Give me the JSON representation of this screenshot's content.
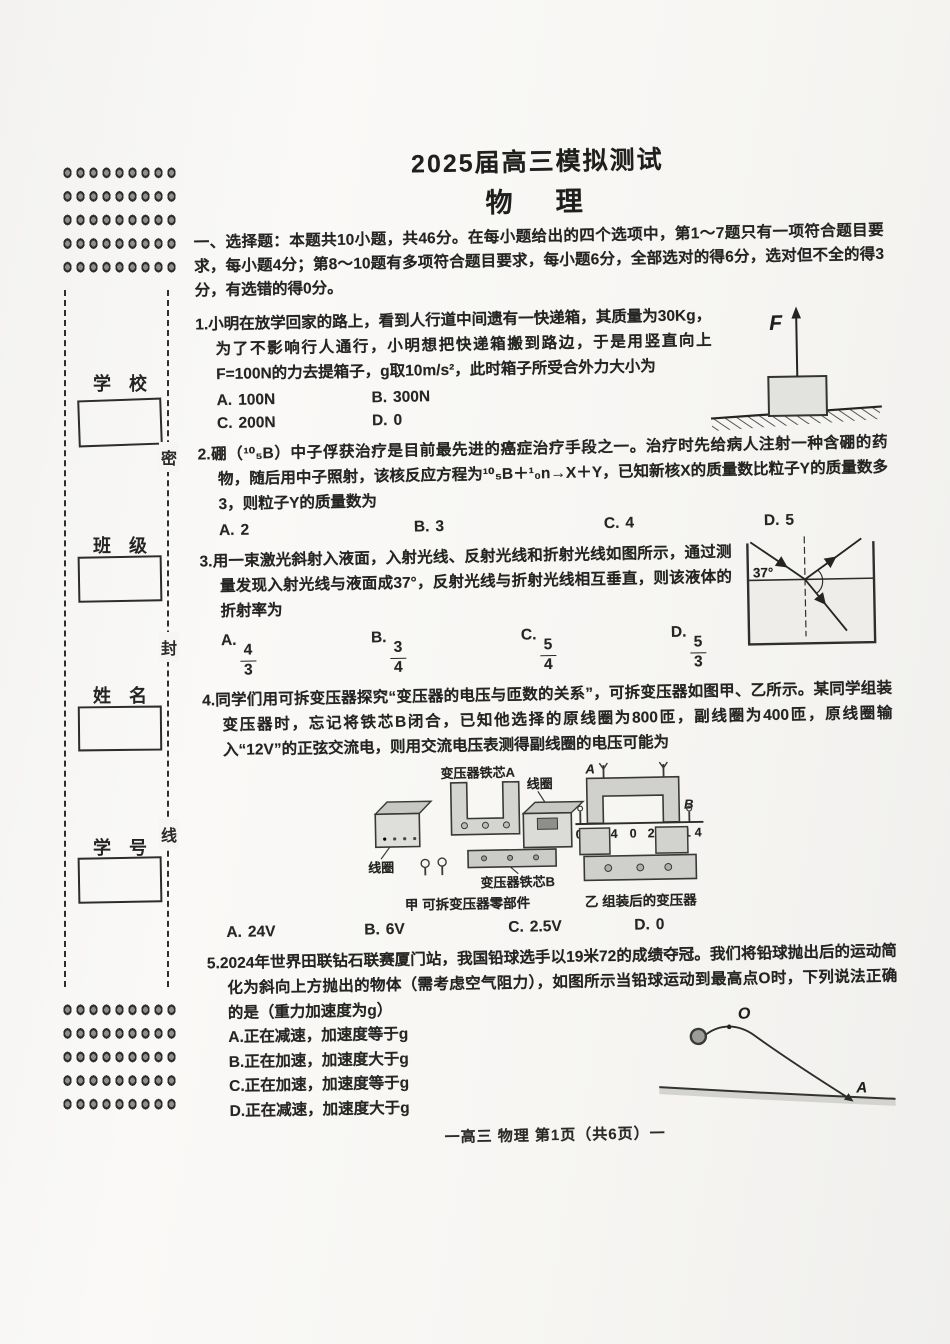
{
  "header": {
    "title": "2025届高三模拟测试",
    "subject": "物　理",
    "footer": "一高三 物理 第1页（共6页）一"
  },
  "sidebar": {
    "seal_chars": [
      "密",
      "封",
      "线"
    ],
    "fields": [
      {
        "label": "学　校"
      },
      {
        "label": "班　级"
      },
      {
        "label": "姓　名"
      },
      {
        "label": "学　号"
      }
    ]
  },
  "section": {
    "intro": "一、选择题：本题共10小题，共46分。在每小题给出的四个选项中，第1～7题只有一项符合题目要求，每小题4分；第8～10题有多项符合题目要求，每小题6分，全部选对的得6分，选对但不全的得3分，有选错的得0分。"
  },
  "questions": [
    {
      "stem": "1.小明在放学回家的路上，看到人行道中间遗有一快递箱，其质量为30Kg，为了不影响行人通行，小明想把快递箱搬到路边，于是用竖直向上F=100N的力去提箱子，g取10m/s²，此时箱子所受合外力大小为",
      "options": [
        {
          "label": "A.",
          "text": "100N"
        },
        {
          "label": "B.",
          "text": "300N"
        },
        {
          "label": "C.",
          "text": "200N"
        },
        {
          "label": "D.",
          "text": "0"
        }
      ],
      "figure": {
        "force_label": "F"
      }
    },
    {
      "stem": "2.硼（¹⁰₅B）中子俘获治疗是目前最先进的癌症治疗手段之一。治疗时先给病人注射一种含硼的药物，随后用中子照射，该核反应方程为¹⁰₅B＋¹₀n→X＋Y，已知新核X的质量数比粒子Y的质量数多3，则粒子Y的质量数为",
      "options": [
        {
          "label": "A.",
          "text": "2"
        },
        {
          "label": "B.",
          "text": "3"
        },
        {
          "label": "C.",
          "text": "4"
        },
        {
          "label": "D.",
          "text": "5"
        }
      ]
    },
    {
      "stem": "3.用一束激光斜射入液面，入射光线、反射光线和折射光线如图所示，通过测量发现入射光线与液面成37°，反射光线与折射光线相互垂直，则该液体的折射率为",
      "options": [
        {
          "label": "A.",
          "num": "4",
          "den": "3"
        },
        {
          "label": "B.",
          "num": "3",
          "den": "4"
        },
        {
          "label": "C.",
          "num": "5",
          "den": "4"
        },
        {
          "label": "D.",
          "num": "5",
          "den": "3"
        }
      ],
      "figure": {
        "angle": "37°"
      }
    },
    {
      "stem": "4.同学们用可拆变压器探究“变压器的电压与匝数的关系”，可拆变压器如图甲、乙所示。某同学组装变压器时，忘记将铁芯B闭合，已知他选择的原线圈为800匝，副线圈为400匝，原线圈输入“12V”的正弦交流电，则用交流电压表测得副线圈的电压可能为",
      "options": [
        {
          "label": "A.",
          "text": "24V"
        },
        {
          "label": "B.",
          "text": "6V"
        },
        {
          "label": "C.",
          "text": "2.5V"
        },
        {
          "label": "D.",
          "text": "0"
        }
      ],
      "figure": {
        "core_a_label": "变压器铁芯A",
        "coil_label_top": "线圈",
        "coil_label_left": "线圈",
        "core_b_label": "变压器铁芯B",
        "caption_left": "甲 可拆变压器零部件",
        "terminal_a": "A",
        "terminal_b": "B",
        "scale_left": "0 1 4",
        "scale_right": "0 2 8 14",
        "caption_right": "乙 组装后的变压器"
      }
    },
    {
      "stem": "5.2024年世界田联钻石联赛厦门站，我国铅球选手以19米72的成绩夺冠。我们将铅球抛出后的运动简化为斜向上方抛出的物体（需考虑空气阻力），如图所示当铅球运动到最高点O时，下列说法正确的是（重力加速度为g）",
      "options": [
        {
          "label": "A.",
          "text": "正在减速，加速度等于g"
        },
        {
          "label": "B.",
          "text": "正在加速，加速度大于g"
        },
        {
          "label": "C.",
          "text": "正在加速，加速度等于g"
        },
        {
          "label": "D.",
          "text": "正在减速，加速度大于g"
        }
      ],
      "figure": {
        "apex_label": "O",
        "landing_label": "A"
      }
    }
  ]
}
